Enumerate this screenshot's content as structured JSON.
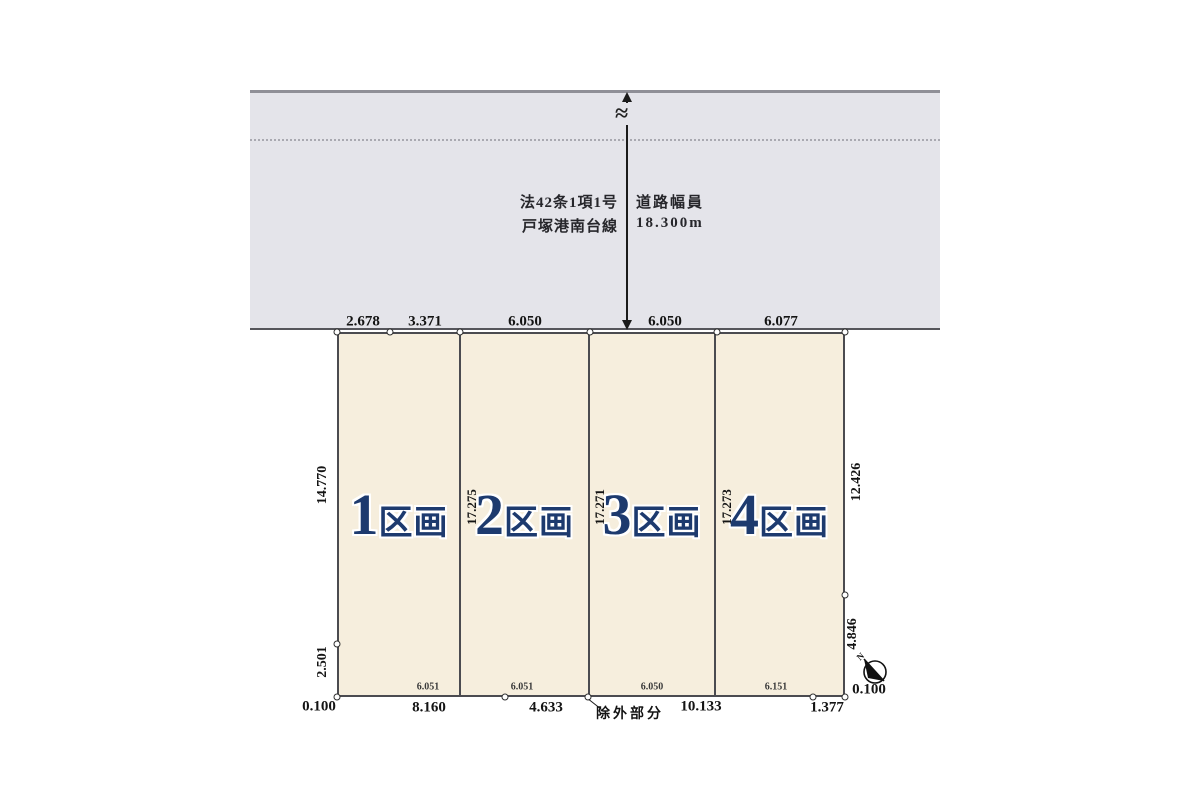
{
  "road": {
    "regulation": "法42条1項1号",
    "width_label": "道路幅員",
    "name": "戸塚港南台線",
    "width_value": "18.300m"
  },
  "plots": [
    {
      "number": "1",
      "suffix": "区画"
    },
    {
      "number": "2",
      "suffix": "区画"
    },
    {
      "number": "3",
      "suffix": "区画"
    },
    {
      "number": "4",
      "suffix": "区画"
    }
  ],
  "dimensions": {
    "top": [
      "2.678",
      "3.371",
      "6.050",
      "6.050",
      "6.077"
    ],
    "left_upper": "14.770",
    "left_lower": "2.501",
    "right_upper": "12.426",
    "right_lower": "4.846",
    "boundary_depths": [
      "17.275",
      "17.271",
      "17.273"
    ],
    "bottom_frontage": [
      "6.051",
      "6.051",
      "6.050",
      "6.151"
    ],
    "bottom_outer": [
      "0.100",
      "8.160",
      "4.633",
      "10.133",
      "1.377",
      "0.100"
    ],
    "excluded_label": "除外部分"
  },
  "compass": {
    "north_label": "N"
  },
  "colors": {
    "road_fill": "#e4e4ea",
    "plot_fill": "#f6eedd",
    "plot_label_navy": "#1d3a6e",
    "line_dark": "#4b4b50"
  }
}
